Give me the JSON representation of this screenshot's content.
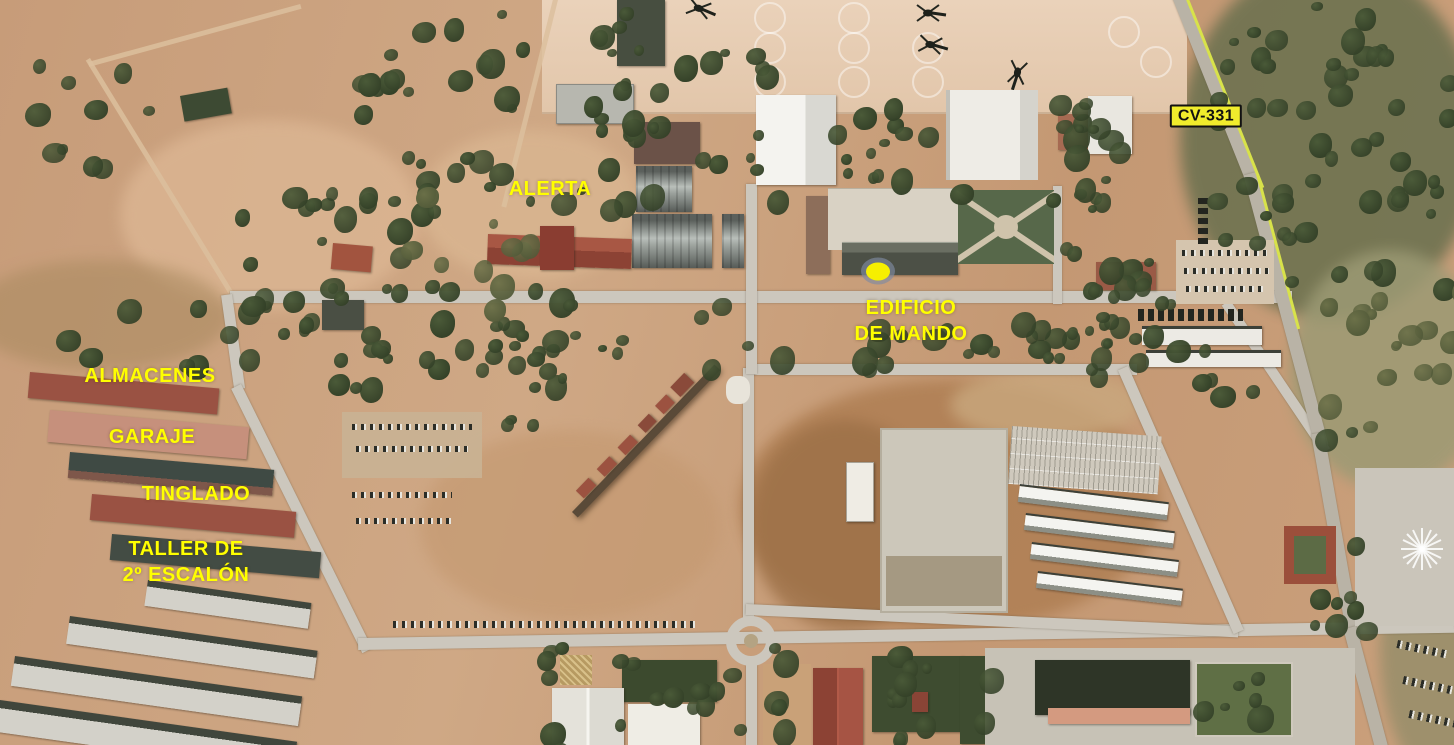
{
  "map": {
    "type": "satellite-aerial-annotated",
    "colors": {
      "label_yellow": "#ffff00",
      "marker_fill": "#f6ef00",
      "marker_halo": "#808aa2",
      "sign_bg": "#f0ec2c",
      "sign_text": "#111111",
      "road_line": "#d8e24a"
    }
  },
  "annotations": {
    "labels": [
      {
        "id": "alerta",
        "lines": [
          "ALERTA"
        ],
        "x": 550,
        "y": 189
      },
      {
        "id": "edificio-de-mando",
        "lines": [
          "EDIFICIO",
          "DE MANDO"
        ],
        "x": 911,
        "y": 321
      },
      {
        "id": "almacenes",
        "lines": [
          "ALMACENES"
        ],
        "x": 150,
        "y": 376
      },
      {
        "id": "garaje",
        "lines": [
          "GARAJE"
        ],
        "x": 152,
        "y": 437
      },
      {
        "id": "tinglado",
        "lines": [
          "TINGLADO"
        ],
        "x": 196,
        "y": 494
      },
      {
        "id": "taller-2-escalon",
        "lines": [
          "TALLER DE",
          "2º ESCALÓN"
        ],
        "x": 186,
        "y": 562
      }
    ],
    "road_sign": {
      "text": "CV-331",
      "x": 1206,
      "y": 116
    },
    "marker": {
      "shape": "ellipse",
      "x": 878,
      "y": 271
    }
  }
}
